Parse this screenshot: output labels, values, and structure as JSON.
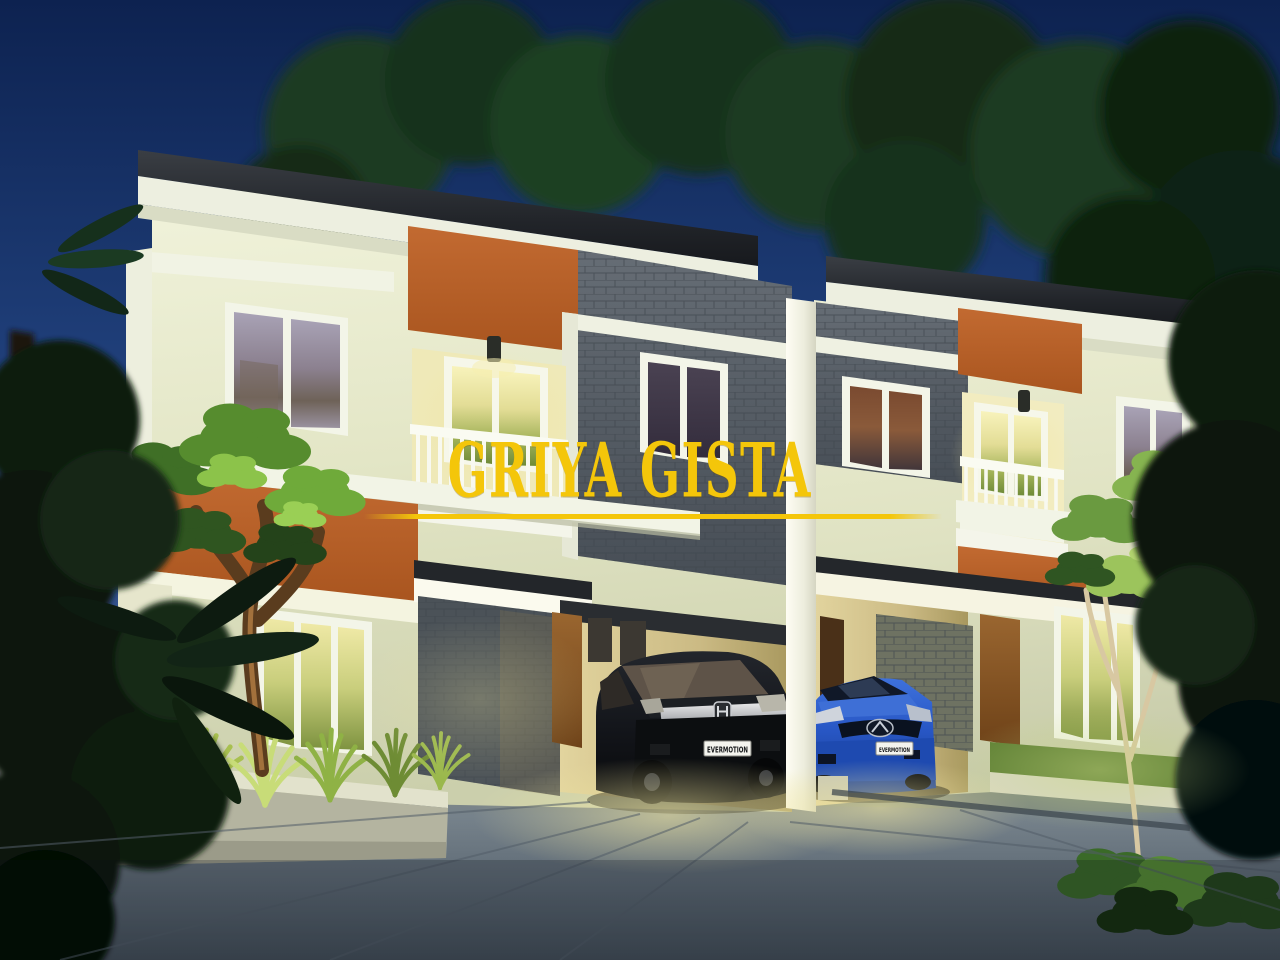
{
  "branding": {
    "title": "GRIYA GISTA",
    "title_color": "#F4C60A"
  },
  "vehicles": {
    "black_suv": {
      "badge": "honda-logo",
      "plate": "EVERMOTION"
    },
    "blue_sedan": {
      "badge": "mazda-logo",
      "plate": "EVERMOTION"
    }
  },
  "palette": {
    "sky_top": "#0D2250",
    "sky_bottom": "#4E6C9D",
    "wall_cream": "#E8EBD0",
    "trim_white": "#F3F5E8",
    "accent_orange": "#B5622C",
    "stone_grey": "#5D646B",
    "roof_dark": "#26292D",
    "foliage_dark": "#12240F",
    "foliage_lit": "#7FB43E",
    "driveway_grey": "#6D7A86",
    "warm_window_light": "#F2ECB4",
    "car_blue": "#2A5BC8",
    "car_black": "#101215"
  }
}
